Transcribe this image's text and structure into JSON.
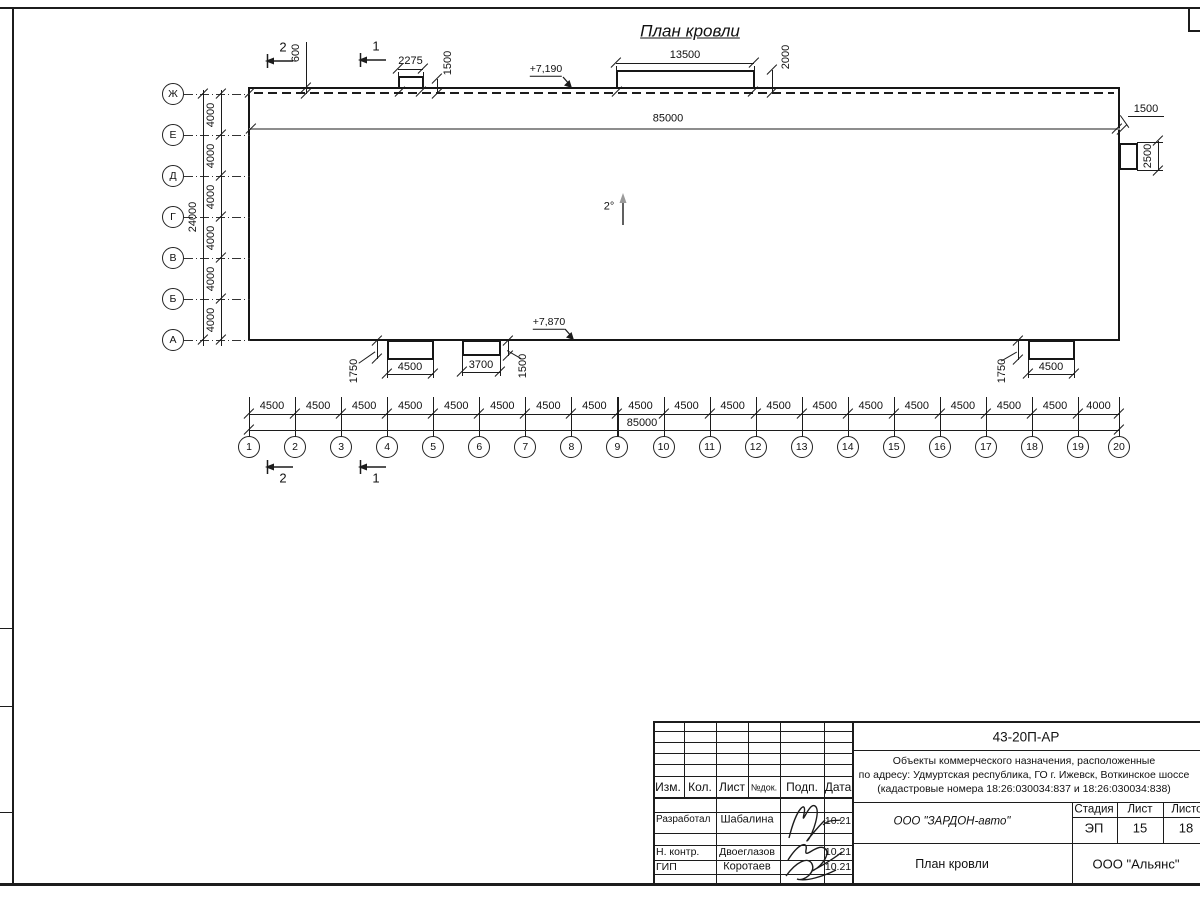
{
  "sheet": {
    "title": "План кровли",
    "slope_label": "2°"
  },
  "axes": {
    "left": {
      "labels": [
        "Ж",
        "Е",
        "Д",
        "Г",
        "В",
        "Б",
        "А"
      ],
      "segment_dims": [
        "4000",
        "4000",
        "4000",
        "4000",
        "4000",
        "4000"
      ],
      "total_dim": "24000"
    },
    "bottom": {
      "labels": [
        "1",
        "2",
        "3",
        "4",
        "5",
        "6",
        "7",
        "8",
        "9",
        "10",
        "11",
        "12",
        "13",
        "14",
        "15",
        "16",
        "17",
        "18",
        "19",
        "20"
      ],
      "segment_dims": [
        "4500",
        "4500",
        "4500",
        "4500",
        "4500",
        "4500",
        "4500",
        "4500",
        "4500",
        "4500",
        "4500",
        "4500",
        "4500",
        "4500",
        "4500",
        "4500",
        "4500",
        "4500",
        "4000"
      ],
      "total_dim": "85000"
    }
  },
  "dims": {
    "building_length": "85000",
    "parapet_offset": "600",
    "canopy_small_width": "2275",
    "canopy_small_depth": "1500",
    "canopy_top_width": "13500",
    "canopy_top_depth": "2000",
    "right_ledge_offset": "1500",
    "right_ledge_depth": "2500",
    "bottom_canopy1_width": "4500",
    "bottom_canopy1_depth": "1750",
    "bottom_canopy2_width": "3700",
    "bottom_canopy2_depth": "1500",
    "bottom_canopy3_width": "4500",
    "bottom_canopy3_depth": "1750"
  },
  "marks": {
    "elev_top": "+7,190",
    "elev_bottom": "+7,870",
    "section_1": "1",
    "section_2": "2"
  },
  "title_block": {
    "doc_number": "43-20П-АР",
    "address_line1": "Объекты коммерческого назначения, расположенные",
    "address_line2": "по адресу: Удмуртская республика, ГО г. Ижевск, Воткинское шоссе",
    "address_line3": "(кадастровые номера 18:26:030034:837 и 18:26:030034:838)",
    "header_cols": [
      "Изм.",
      "Кол.",
      "Лист",
      "№док.",
      "Подп.",
      "Дата"
    ],
    "rows": [
      {
        "role": "Разработал",
        "name": "Шабалина",
        "date": "10.21"
      },
      {
        "role": "Н. контр.",
        "name": "Двоеглазов",
        "date": "10.21"
      },
      {
        "role": "ГИП",
        "name": "Коротаев",
        "date": "10.21"
      }
    ],
    "company": "ООО \"ЗАРДОН-авто\"",
    "doc_title": "План кровли",
    "stage_label": "Стадия",
    "stage_value": "ЭП",
    "sheet_label": "Лист",
    "sheet_value": "15",
    "sheets_label": "Листов",
    "sheets_value": "18",
    "org": "ООО \"Альянс\""
  }
}
